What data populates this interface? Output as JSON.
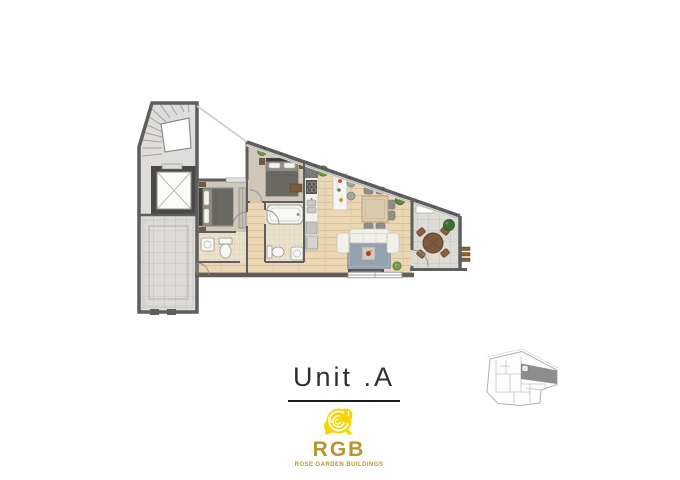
{
  "page": {
    "background_color": "#ffffff"
  },
  "plan_title": {
    "label": "Unit .A"
  },
  "brand": {
    "initials": "RGB",
    "tagline": "ROSE GARDEN BUILDINGS",
    "rose_color": "#f6d506",
    "gold_color": "#b5952d"
  },
  "floor_plan": {
    "description": "Apartment floor plan for Unit A with sloped glazed facade",
    "rooms": [
      "stairwell",
      "elevator",
      "stone-courtyard",
      "bedroom-1",
      "bathroom-1",
      "hallway",
      "bedroom-2",
      "bathroom-2",
      "kitchen",
      "living-dining-room",
      "balcony"
    ],
    "colors": {
      "wall": "#5e5e5e",
      "wood_floor": "#ebd7b4",
      "tile_floor": "#ece1cb",
      "stone_floor": "#dcdbd6",
      "bedroom_floor": "#cfc8ba",
      "marble": "#e0dfdc",
      "rug": "#94a1ae",
      "sofa": "#f1f0e9",
      "bed_blanket": "#6b6a61",
      "outdoor_table": "#7d5a3c",
      "plant": "#5d8a3c"
    }
  },
  "key_plan": {
    "highlighted_unit": "A",
    "highlight_color": "#8d8d8d",
    "outline_color": "#b0b0b0"
  }
}
